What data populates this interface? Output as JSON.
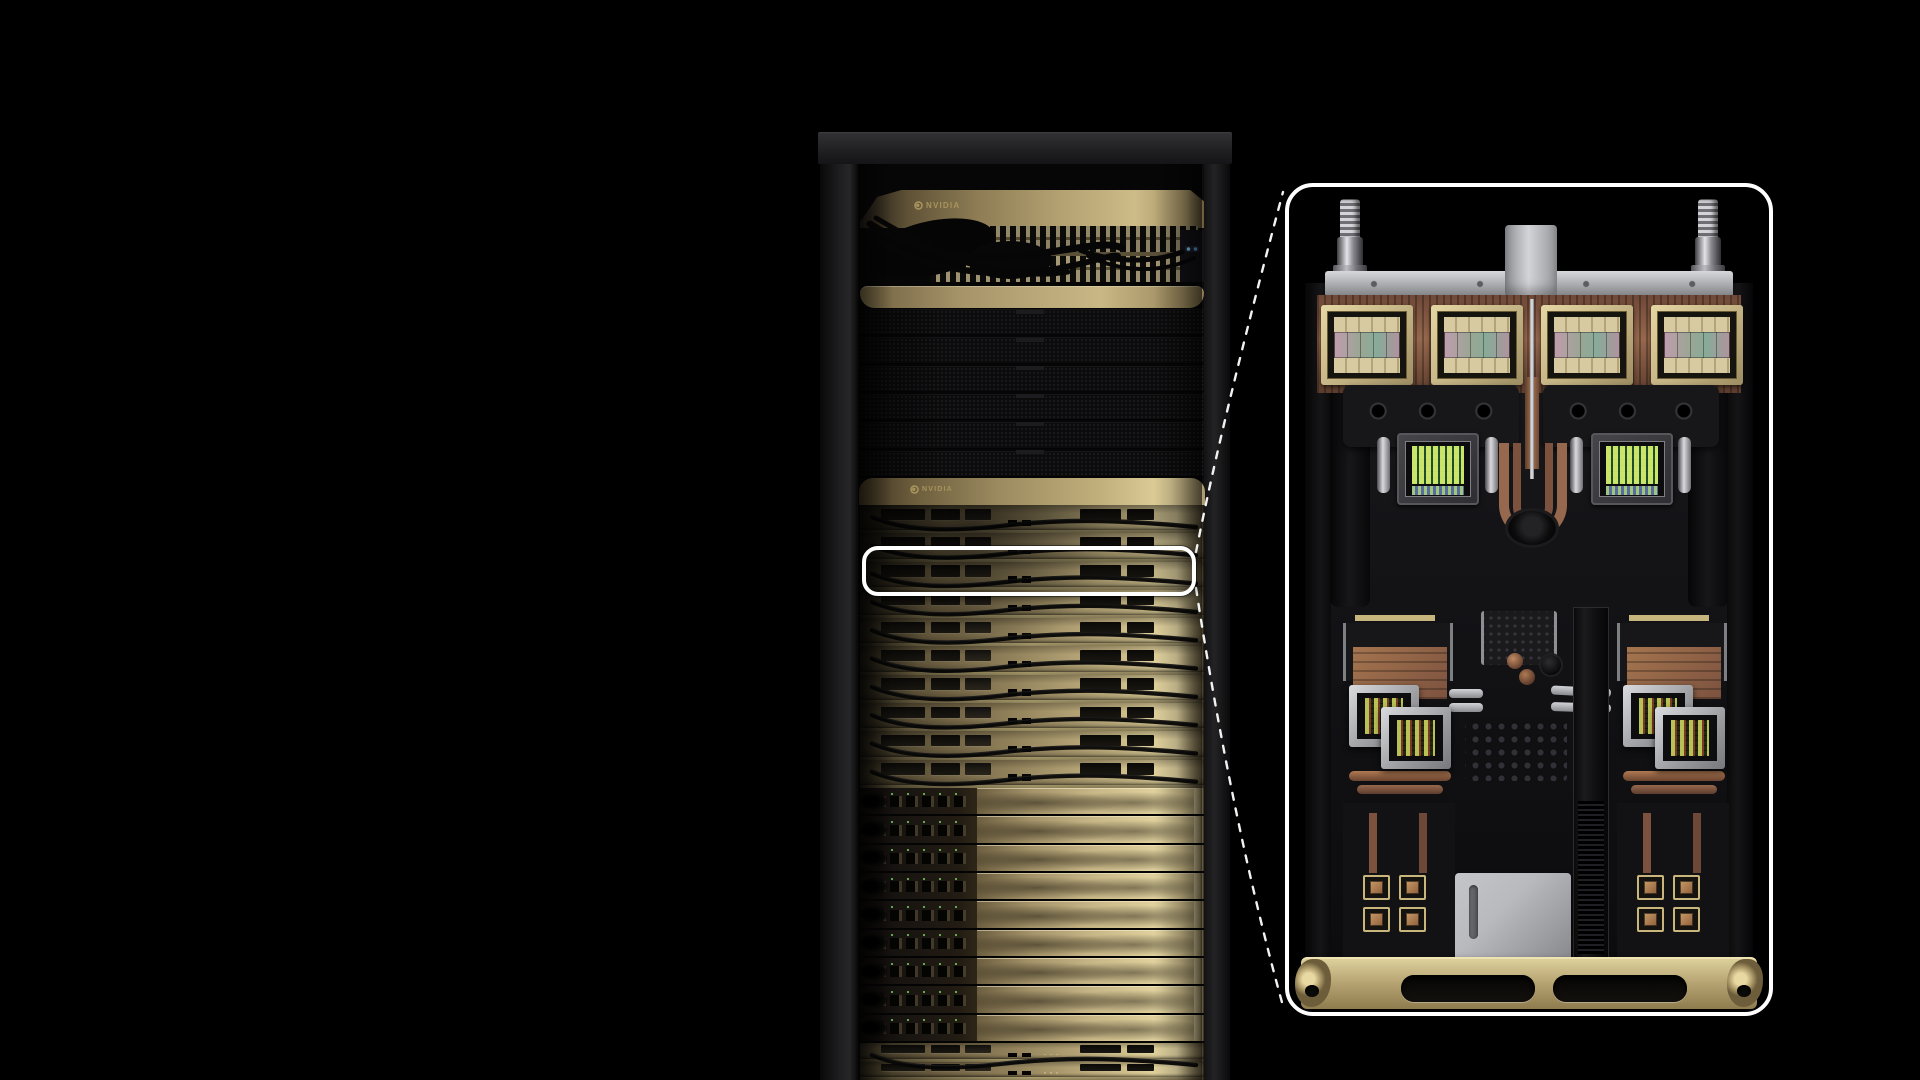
{
  "scene": {
    "background": "#000000"
  },
  "rack": {
    "brand_top": "NVIDIA",
    "brand_mid": "NVIDIA",
    "mesh_rows": 6,
    "compute_trays": 10,
    "nvswitch_trays": 9,
    "bottom_trays": 2,
    "colors": {
      "gold_bright": "#e9dcab",
      "gold_mid": "#b3a274",
      "gold_dark": "#4a4231",
      "logo_gold": "#a8945c"
    }
  },
  "callout": {
    "border_color": "#ffffff"
  },
  "leaders": {
    "color": "#f2f2f2",
    "style": "dashed"
  },
  "detail": {
    "border_color": "#ffffff",
    "gpu_packages": 4,
    "cpu_packages": 2,
    "nic_packages_per_side": 2,
    "small_chips_per_side": 4,
    "coolant_posts": 2,
    "handle_cutouts": 2,
    "colors": {
      "copper": "#96684d",
      "silver": "#b9babe",
      "gold_frame": "#c3b283",
      "die_beige": "#d8caa0",
      "die_irid_a": "#c09cae",
      "die_irid_b": "#88ab99",
      "front_gold": "#c7b57e"
    }
  }
}
